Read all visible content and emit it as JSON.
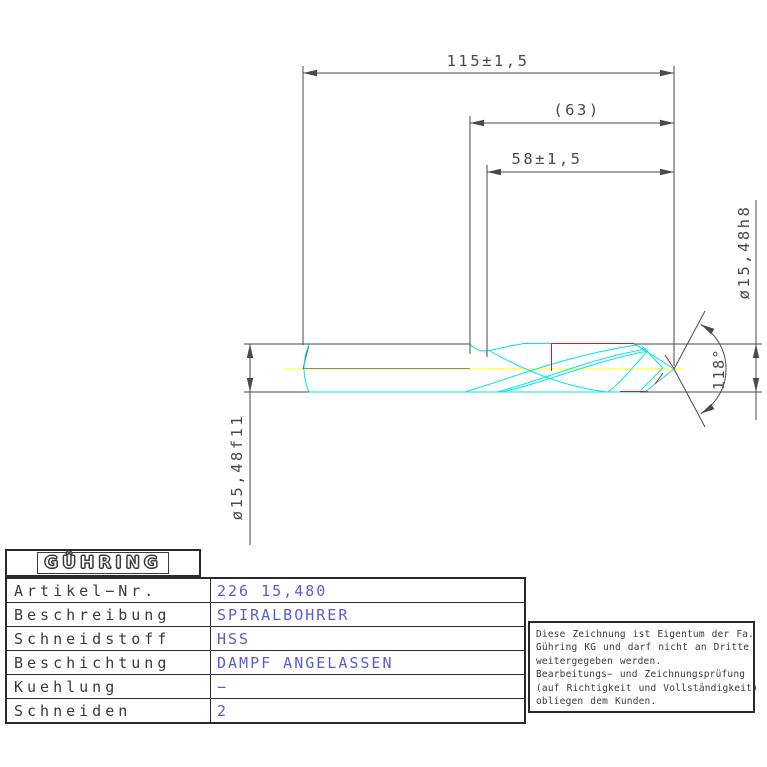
{
  "dimensions": {
    "overall_length": "115±1,5",
    "reference_length": "(63)",
    "flute_length": "58±1,5",
    "point_diameter": "ø15,48h8",
    "shank_diameter": "ø15,48f11",
    "point_angle": "118°"
  },
  "titleblock": {
    "logo": "GÜHRING",
    "rows": [
      {
        "label": "Artikel−Nr.",
        "value": "226 15,480"
      },
      {
        "label": "Beschreibung",
        "value": "SPIRALBOHRER"
      },
      {
        "label": "Schneidstoff",
        "value": "HSS"
      },
      {
        "label": "Beschichtung",
        "value": "DAMPF ANGELASSEN"
      },
      {
        "label": "Kuehlung",
        "value": "−"
      },
      {
        "label": "Schneiden",
        "value": "2"
      }
    ]
  },
  "notice": {
    "lines": [
      "Diese Zeichnung ist Eigentum der Fa.",
      "Gühring KG und darf nicht an Dritte",
      "weitergegeben werden.",
      "Bearbeitungs− und Zeichnungsprüfung",
      "(auf Richtigkeit und Vollständigkeit)",
      "obliegen dem Kunden."
    ]
  },
  "colors": {
    "dimension_lines": "#4a4a4a",
    "drill_outline": "#00e8e8",
    "margin_lines": "#e81010",
    "centerline": "#ffff70",
    "value_text": "#5a5ad8"
  }
}
